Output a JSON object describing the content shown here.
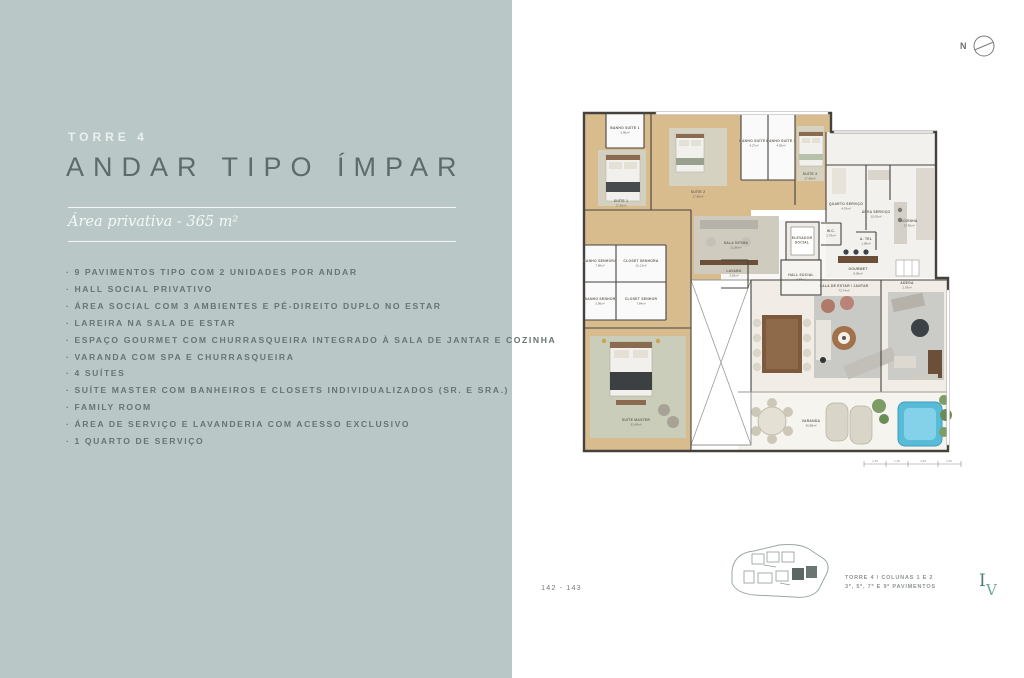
{
  "left_panel": {
    "tower_label": "TORRE 4",
    "title": "ANDAR TIPO ÍMPAR",
    "area_line": "Área privativa - 365 m²",
    "features": [
      "9 PAVIMENTOS TIPO COM 2 UNIDADES POR ANDAR",
      "HALL SOCIAL PRIVATIVO",
      "ÁREA SOCIAL COM 3 AMBIENTES E PÉ-DIREITO DUPLO NO ESTAR",
      "LAREIRA NA SALA DE ESTAR",
      "ESPAÇO GOURMET COM CHURRASQUEIRA INTEGRADO À SALA DE JANTAR E COZINHA",
      "VARANDA COM SPA E CHURRASQUEIRA",
      "4 SUÍTES",
      "SUÍTE MASTER COM BANHEIROS E CLOSETS INDIVIDUALIZADOS (SR. E SRA.)",
      "FAMILY ROOM",
      "ÁREA DE SERVIÇO E LAVANDERIA COM ACESSO EXCLUSIVO",
      "1 QUARTO DE SERVIÇO"
    ]
  },
  "compass": {
    "north_label": "N"
  },
  "page_number": "142 - 143",
  "keyplan": {
    "caption_line1": "TORRE 4 / COLUNAS 1 E 2",
    "caption_line2": "3º, 5º, 7º E 9º PAVIMENTOS"
  },
  "logo": {
    "letter_i": "I",
    "letter_v": "V"
  },
  "plan": {
    "rooms": {
      "suite1": {
        "label": "SUÍTE 1",
        "area": "17,56m²"
      },
      "banho_suite1": {
        "label": "BANHO SUÍTE 1",
        "area": "3,96m²"
      },
      "suite2": {
        "label": "SUÍTE 2",
        "area": "17,88m²"
      },
      "banho_suite2": {
        "label": "BANHO SUÍTE 2",
        "area": "4,27m²"
      },
      "banho_suite3": {
        "label": "BANHO SUÍTE 3",
        "area": "4,28m²"
      },
      "suite3": {
        "label": "SUÍTE 3",
        "area": "17,88m²"
      },
      "quarto_servico": {
        "label": "QUARTO SERVIÇO",
        "area": "4,76m²"
      },
      "area_servico": {
        "label": "ÁREA SERVIÇO",
        "area": "10,05m²"
      },
      "cozinha": {
        "label": "COZINHA",
        "area": "17,36m²"
      },
      "sala_intima": {
        "label": "SALA ÍNTIMA",
        "area": "21,86m²"
      },
      "elevador_social": {
        "label": "ELEVADOR",
        "area": "SOCIAL"
      },
      "hall_social": {
        "label": "HALL SOCIAL",
        "area": "6,88m²"
      },
      "lavabo": {
        "label": "LAVABO",
        "area": "3,55m²"
      },
      "wc": {
        "label": "W.C.",
        "area": "2,79m²"
      },
      "a_tel": {
        "label": "A. TEL",
        "area": "1,58m²"
      },
      "gourmet": {
        "label": "GOURMET",
        "area": "8,06m²"
      },
      "adega": {
        "label": "ADEGA",
        "area": "2,78m²"
      },
      "banho_senhora": {
        "label": "BANHO SENHORA",
        "area": "7,86m²"
      },
      "closet_senhora": {
        "label": "CLOSET SENHORA",
        "area": "10,13m²"
      },
      "banho_senhor": {
        "label": "BANHO SENHOR",
        "area": "5,86m²"
      },
      "closet_senhor": {
        "label": "CLOSET SENHOR",
        "area": "7,84m²"
      },
      "suite_master": {
        "label": "SUÍTE MASTER",
        "area": "31,48m²"
      },
      "sala_estar": {
        "label": "SALA DE ESTAR / JANTAR",
        "area": "73,74m²"
      },
      "varanda": {
        "label": "VARANDA",
        "area": "36,88m²"
      }
    },
    "scalebar": {
      "d1": "1,45",
      "d2": "1,45",
      "d3": "4,45",
      "d4": "3,45"
    }
  },
  "colors": {
    "panel_bg": "#b9c8c6",
    "title": "#5d6c68",
    "wood_floor": "#d9bc8e",
    "spa_blue": "#58bcd9",
    "plant_green": "#7d9c66",
    "logo_teal": "#4a8177"
  }
}
